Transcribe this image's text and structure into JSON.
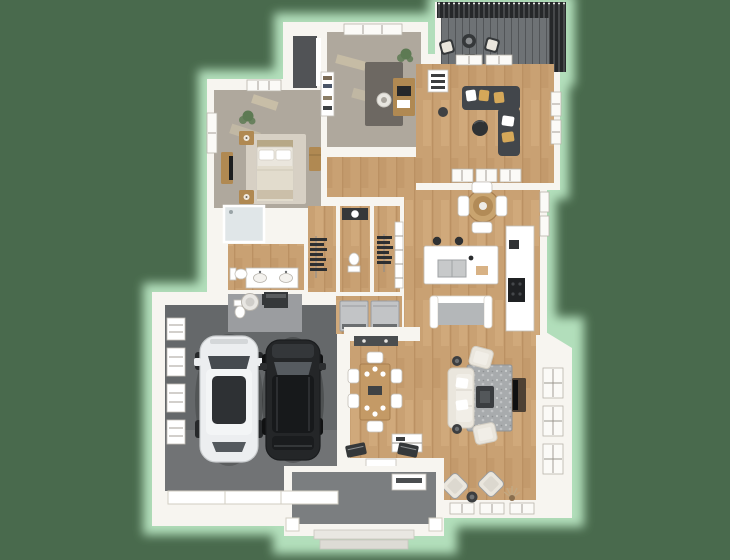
{
  "window": {
    "width": 730,
    "height": 560
  },
  "scene": {
    "type": "3d-floor-plan-render",
    "style": "birds-eye dollhouse view, white walls, green backdrop with mint glow",
    "rooms": [
      {
        "id": "garage",
        "label": "2-Car Garage",
        "floor": "concrete-gray",
        "contents": [
          "white-suv",
          "black-suv",
          "water-heater",
          "furnace",
          "wall-shelves",
          "garage-door"
        ]
      },
      {
        "id": "front-porch",
        "label": "Front Porch",
        "floor": "concrete-gray",
        "contents": [
          "steps",
          "columns",
          "storage-bench"
        ]
      },
      {
        "id": "entry",
        "label": "Entry Foyer",
        "floor": "wood",
        "contents": [
          "front-door",
          "coat-closet",
          "shoe-benches"
        ]
      },
      {
        "id": "great-room",
        "label": "Great Room",
        "floor": "wood",
        "contents": [
          "cream-sofa",
          "stone-rug",
          "fire-table",
          "armchairs",
          "tv-console",
          "accent-chair-pair",
          "side-tables",
          "dried-plant",
          "loveseat",
          "sideboard"
        ]
      },
      {
        "id": "dining-area",
        "label": "Dining Area",
        "floor": "wood",
        "contents": [
          "rectangular-table",
          "six-white-chairs",
          "place-settings"
        ]
      },
      {
        "id": "kitchen",
        "label": "Kitchen",
        "floor": "wood",
        "contents": [
          "island-with-sink",
          "bar-stools",
          "wall-counter",
          "black-range",
          "pantry-shelves"
        ]
      },
      {
        "id": "breakfast-nook",
        "label": "Breakfast Nook",
        "floor": "wood",
        "contents": [
          "round-rattan-table",
          "four-white-chairs"
        ]
      },
      {
        "id": "family-room",
        "label": "Family Room Sunroom",
        "floor": "wood",
        "contents": [
          "charcoal-sectional",
          "round-ottoman",
          "tan-pillows",
          "media-cabinet",
          "interior-window-band"
        ]
      },
      {
        "id": "deck",
        "label": "Deck",
        "floor": "composite-gray",
        "contents": [
          "black-slat-railing",
          "three-lounge-chairs",
          "fire-pit-table"
        ]
      },
      {
        "id": "office",
        "label": "Office Study",
        "floor": "carpet",
        "contents": [
          "desk",
          "swivel-chair",
          "dark-rug",
          "bookshelf",
          "plant",
          "closet"
        ]
      },
      {
        "id": "bedroom",
        "label": "Primary Bedroom",
        "floor": "carpet",
        "contents": [
          "bed",
          "two-nightstands",
          "dresser-with-tv",
          "tall-chest",
          "area-rug",
          "plant"
        ]
      },
      {
        "id": "master-bath",
        "label": "Primary Bathroom",
        "floor": "wood",
        "contents": [
          "walk-in-shower",
          "double-vanity",
          "toilet"
        ]
      },
      {
        "id": "walk-in-closet",
        "label": "Walk-in Closets",
        "floor": "wood",
        "contents": [
          "hanging-clothes"
        ]
      },
      {
        "id": "hall-bath",
        "label": "Hall Bathroom",
        "floor": "wood",
        "contents": [
          "dark-vanity",
          "toilet"
        ]
      },
      {
        "id": "powder-room",
        "label": "Powder Mud Room",
        "floor": "tile-gray",
        "contents": [
          "toilet",
          "dark-vanity"
        ]
      },
      {
        "id": "laundry",
        "label": "Laundry",
        "floor": "wood",
        "contents": [
          "washer",
          "dryer"
        ]
      },
      {
        "id": "hallway",
        "label": "Hallway",
        "floor": "wood",
        "contents": []
      }
    ],
    "vehicles": [
      {
        "id": "white-suv",
        "body": "suv",
        "color": "white"
      },
      {
        "id": "black-suv",
        "body": "suv",
        "color": "black"
      }
    ]
  },
  "colors": {
    "bg": "#496a4d",
    "glow": "#b8e5c1",
    "wall": "#f7f5f0",
    "wallShade": "#ddd8d0",
    "wood": "#c9a173",
    "woodLight": "#d9b386",
    "woodDark": "#ad8154",
    "carpet": "#afa89d",
    "carpetLight": "#ddcfae",
    "garage": "#65686a",
    "deck": "#6e7275",
    "railing": "#26282a",
    "porch": "#7b7e80",
    "sofaDark": "#42464b",
    "pillowTan": "#d5a859",
    "cream": "#eae6dd",
    "creamShade": "#d2cdc2",
    "rugStone": "#a8abad",
    "rugLight": "#d7d0c4",
    "woodFurn": "#b08952",
    "dark": "#35383a",
    "steel": "#c2c4c6",
    "glass": "#e0e6e8",
    "green": "#5d7a53",
    "carWhite": "#eceef0",
    "carBlack": "#242628"
  }
}
